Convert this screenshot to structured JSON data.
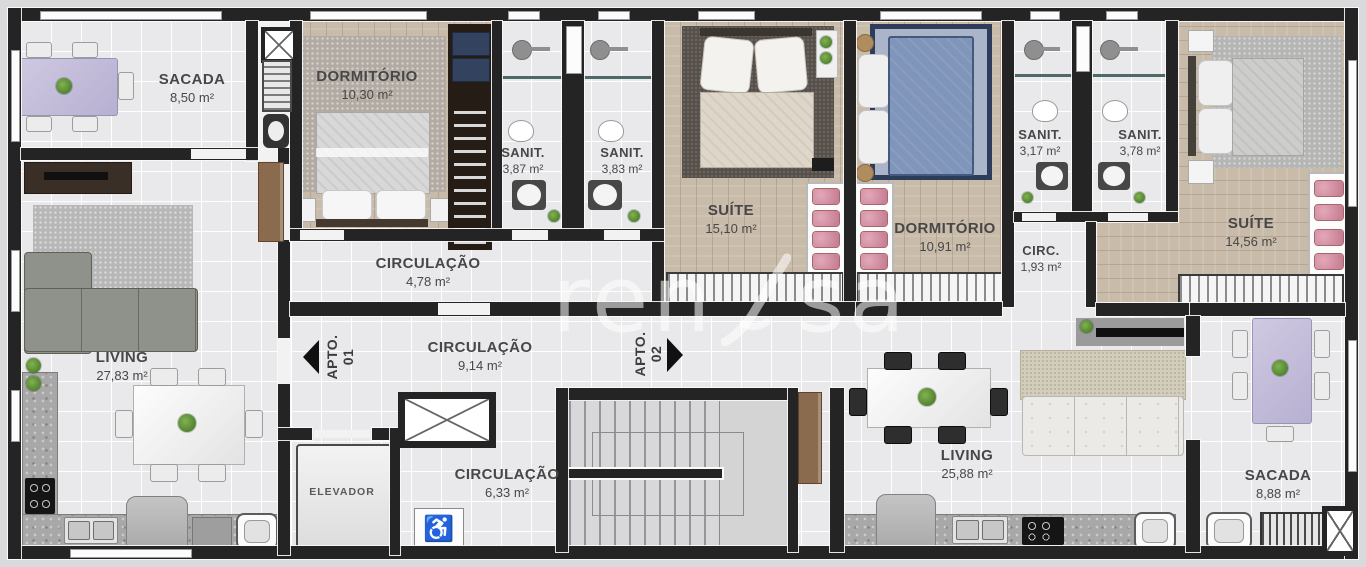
{
  "watermark": {
    "left": "ren",
    "right": "sa"
  },
  "tags": {
    "apto1": {
      "name": "APTO.",
      "num": "01"
    },
    "apto2": {
      "name": "APTO.",
      "num": "02"
    }
  },
  "rooms": {
    "sacada1": {
      "name": "SACADA",
      "area": "8,50 m²"
    },
    "dormitorio1": {
      "name": "DORMITÓRIO",
      "area": "10,30 m²"
    },
    "sanit1": {
      "name": "SANIT.",
      "area": "3,87 m²"
    },
    "sanit2": {
      "name": "SANIT.",
      "area": "3,83 m²"
    },
    "suite1": {
      "name": "SUÍTE",
      "area": "15,10 m²"
    },
    "circulacao1": {
      "name": "CIRCULAÇÃO",
      "area": "4,78 m²"
    },
    "living1": {
      "name": "LIVING",
      "area": "27,83 m²"
    },
    "hall": {
      "name": "CIRCULAÇÃO",
      "area": "9,14 m²"
    },
    "elevador": {
      "name": "ELEVADOR"
    },
    "circulacao3": {
      "name": "CIRCULAÇÃO",
      "area": "6,33 m²"
    },
    "dormitorio2": {
      "name": "DORMITÓRIO",
      "area": "10,91 m²"
    },
    "sanit3": {
      "name": "SANIT.",
      "area": "3,17 m²"
    },
    "sanit4": {
      "name": "SANIT.",
      "area": "3,78 m²"
    },
    "suite2": {
      "name": "SUÍTE",
      "area": "14,56 m²"
    },
    "circ2": {
      "name": "CIRC.",
      "area": "1,93 m²"
    },
    "living2": {
      "name": "LIVING",
      "area": "25,88 m²"
    },
    "sacada2": {
      "name": "SACADA",
      "area": "8,88 m²"
    }
  },
  "icons": {
    "accessible": "♿"
  },
  "colors": {
    "wall": "#242424",
    "wood": "#c9bbaa",
    "tile": "#e9e9ec",
    "table_purple": "#c7c0dc",
    "wardrobe_pink": "#d793a8",
    "bed_blue": "#8095ba",
    "rug_blue_border": "#2c3c59"
  }
}
